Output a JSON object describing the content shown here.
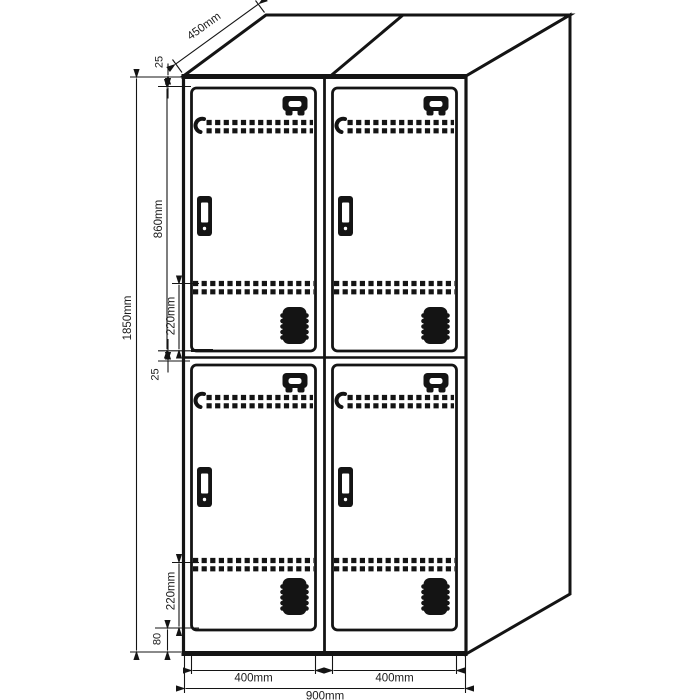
{
  "drawing": {
    "subject": "double-tier locker cabinet technical drawing, 2x2 compartments, isometric line art",
    "background": "#ffffff",
    "line_color": "#141414",
    "dims": {
      "depth": "450mm",
      "top_frame": "25",
      "door_height": "860mm",
      "vent_upper": "220mm",
      "total_height": "1850mm",
      "mid_frame": "25",
      "vent_lower": "220mm",
      "base": "80",
      "door_w_left": "400mm",
      "door_w_right": "400mm",
      "total_width": "900mm"
    }
  }
}
